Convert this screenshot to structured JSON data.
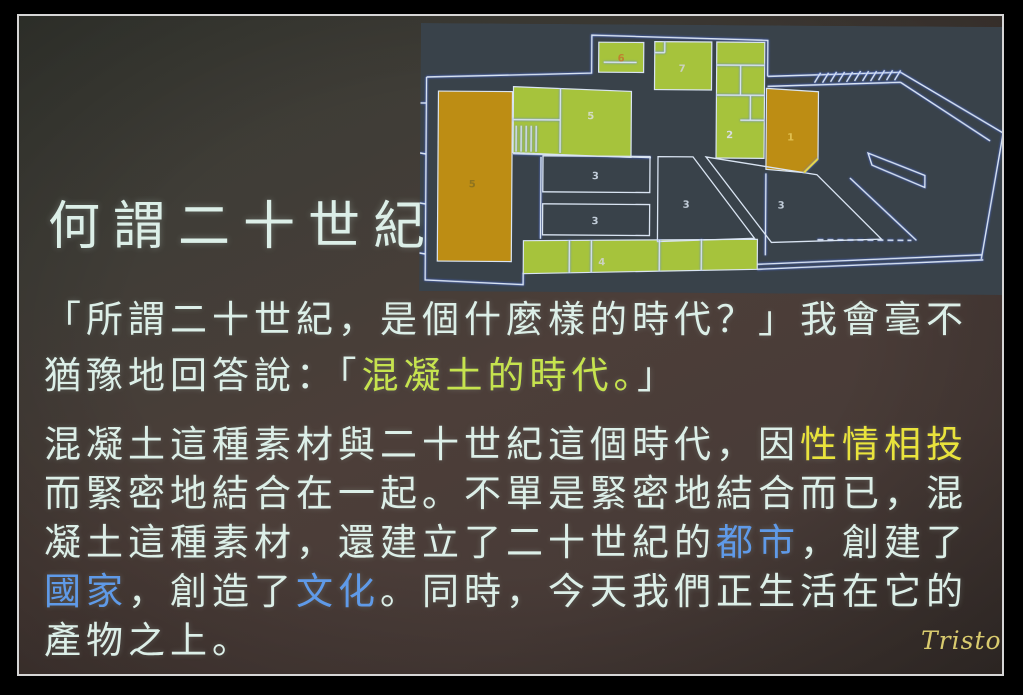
{
  "palette": {
    "frame-line": "#d6d6d6",
    "slide-text": "#dcefe8",
    "hl-green": "#c6e34e",
    "hl-yellow": "#e9e33c",
    "hl-blue": "#5f9ae8",
    "plan-bg": "#39424a",
    "plan-line": "#d9e4f2",
    "plan-green": "#a6c33c",
    "plan-orange": "#bd8d14",
    "watermark": "#d9cb6e"
  },
  "photo": {
    "watermark": "Triston"
  },
  "slide": {
    "title": "何謂二十世紀",
    "paragraph1": {
      "lines": [
        {
          "segments": [
            {
              "text": "「所謂二十世紀，是個什麼樣的時代？」我會毫不",
              "style": "white"
            }
          ]
        },
        {
          "segments": [
            {
              "text": "猶豫地回答說：「",
              "style": "white"
            },
            {
              "text": "混凝土的時代。",
              "style": "green"
            },
            {
              "text": "」",
              "style": "white"
            }
          ]
        }
      ]
    },
    "paragraph2": {
      "lines": [
        {
          "segments": [
            {
              "text": "混凝土這種素材與二十世紀這個時代，因",
              "style": "white"
            },
            {
              "text": "性情相投",
              "style": "yellow"
            }
          ]
        },
        {
          "segments": [
            {
              "text": "而緊密地結合在一起。不單是緊密地結合而已，混",
              "style": "white"
            }
          ]
        },
        {
          "segments": [
            {
              "text": "凝土這種素材，還建立了二十世紀的",
              "style": "white"
            },
            {
              "text": "都市",
              "style": "blue"
            },
            {
              "text": "，創建了",
              "style": "white"
            }
          ]
        },
        {
          "segments": [
            {
              "text": "國家",
              "style": "blue"
            },
            {
              "text": "，創造了",
              "style": "white"
            },
            {
              "text": "文化",
              "style": "blue"
            },
            {
              "text": "。同時，今天我們正生活在它的",
              "style": "white"
            }
          ]
        },
        {
          "segments": [
            {
              "text": "產物之上。",
              "style": "white"
            }
          ]
        }
      ]
    }
  },
  "floor_plan": {
    "rooms": [
      {
        "id": "room-6",
        "label": "6",
        "fill": "green"
      },
      {
        "id": "room-7",
        "label": "7",
        "fill": "green"
      },
      {
        "id": "room-2",
        "label": "2",
        "fill": "green"
      },
      {
        "id": "room-1",
        "label": "1",
        "fill": "orange"
      },
      {
        "id": "room-5-left",
        "label": "5",
        "fill": "orange"
      },
      {
        "id": "room-5-upper",
        "label": "5",
        "fill": "green"
      },
      {
        "id": "room-3-middle-upper",
        "label": "3",
        "fill": "none"
      },
      {
        "id": "room-3-middle-lower",
        "label": "3",
        "fill": "none"
      },
      {
        "id": "room-3-court-left",
        "label": "3",
        "fill": "none"
      },
      {
        "id": "room-3-court-right",
        "label": "3",
        "fill": "none"
      },
      {
        "id": "room-4",
        "label": "4",
        "fill": "green"
      }
    ]
  }
}
